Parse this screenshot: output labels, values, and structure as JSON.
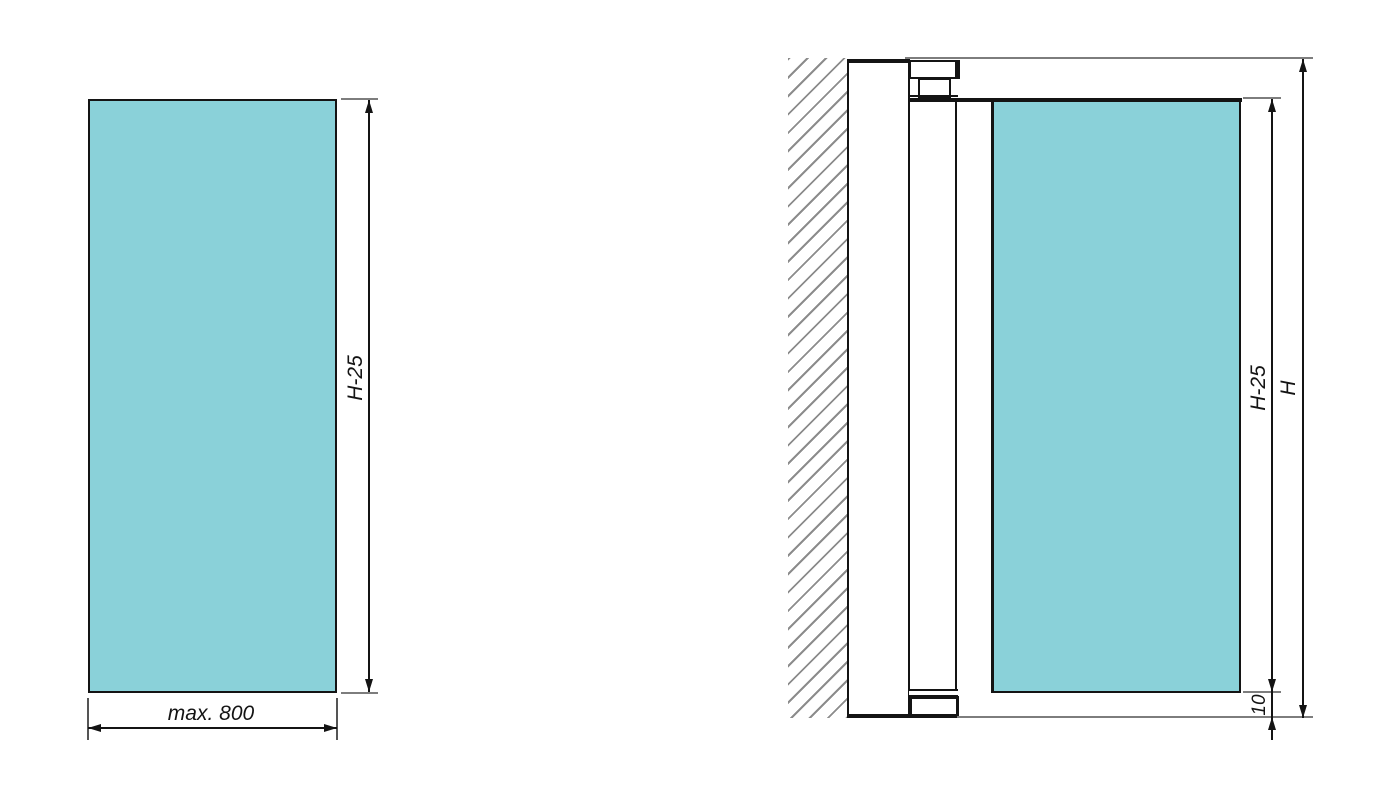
{
  "drawing": {
    "title": "panel-dimension-drawing",
    "colors": {
      "panel_fill": "#8AD1D9",
      "line": "#141414",
      "extension_line": "#7d7d7d",
      "hatch": "#8c8c8c"
    },
    "front_view": {
      "height_label": "H-25",
      "width_label": "max. 800"
    },
    "section_view": {
      "panel_height_label": "H-25",
      "total_height_label": "H",
      "bottom_gap_label": "10"
    }
  }
}
